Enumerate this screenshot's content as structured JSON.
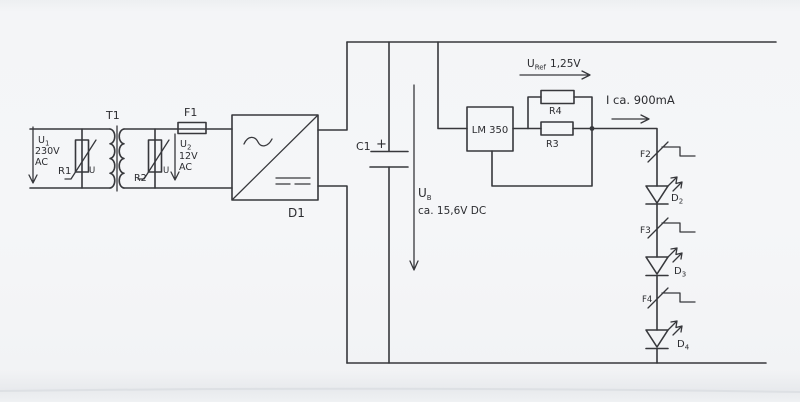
{
  "colors": {
    "ink": "#37383c",
    "paper": "#f4f5f7"
  },
  "schematic": {
    "mains": {
      "u_sym": "U",
      "u_sub": "1",
      "voltage": "230V",
      "kind": "AC",
      "varistor": "R1",
      "varistor_mark": "U"
    },
    "transformer": {
      "label": "T1"
    },
    "secondary": {
      "u_sym": "U",
      "u_sub": "2",
      "voltage": "12V",
      "kind": "AC",
      "varistor": "R2",
      "varistor_mark": "U",
      "fuse": "F1"
    },
    "rectifier": {
      "label": "D1"
    },
    "smoothing": {
      "cap": "C1",
      "plus": "+"
    },
    "bus": {
      "u_sym": "U",
      "u_sub": "B",
      "value": "ca. 15,6V DC"
    },
    "regulator": {
      "chip": "LM 350",
      "r_top": "R4",
      "r_main": "R3",
      "uref_sym": "U",
      "uref_sub": "Ref",
      "uref_val": "1,25V",
      "current": "I ca. 900mA"
    },
    "leds": [
      {
        "fuse": "F2",
        "d_sym": "D",
        "d_sub": "2"
      },
      {
        "fuse": "F3",
        "d_sym": "D",
        "d_sub": "3"
      },
      {
        "fuse": "F4",
        "d_sym": "D",
        "d_sub": "4"
      }
    ]
  }
}
